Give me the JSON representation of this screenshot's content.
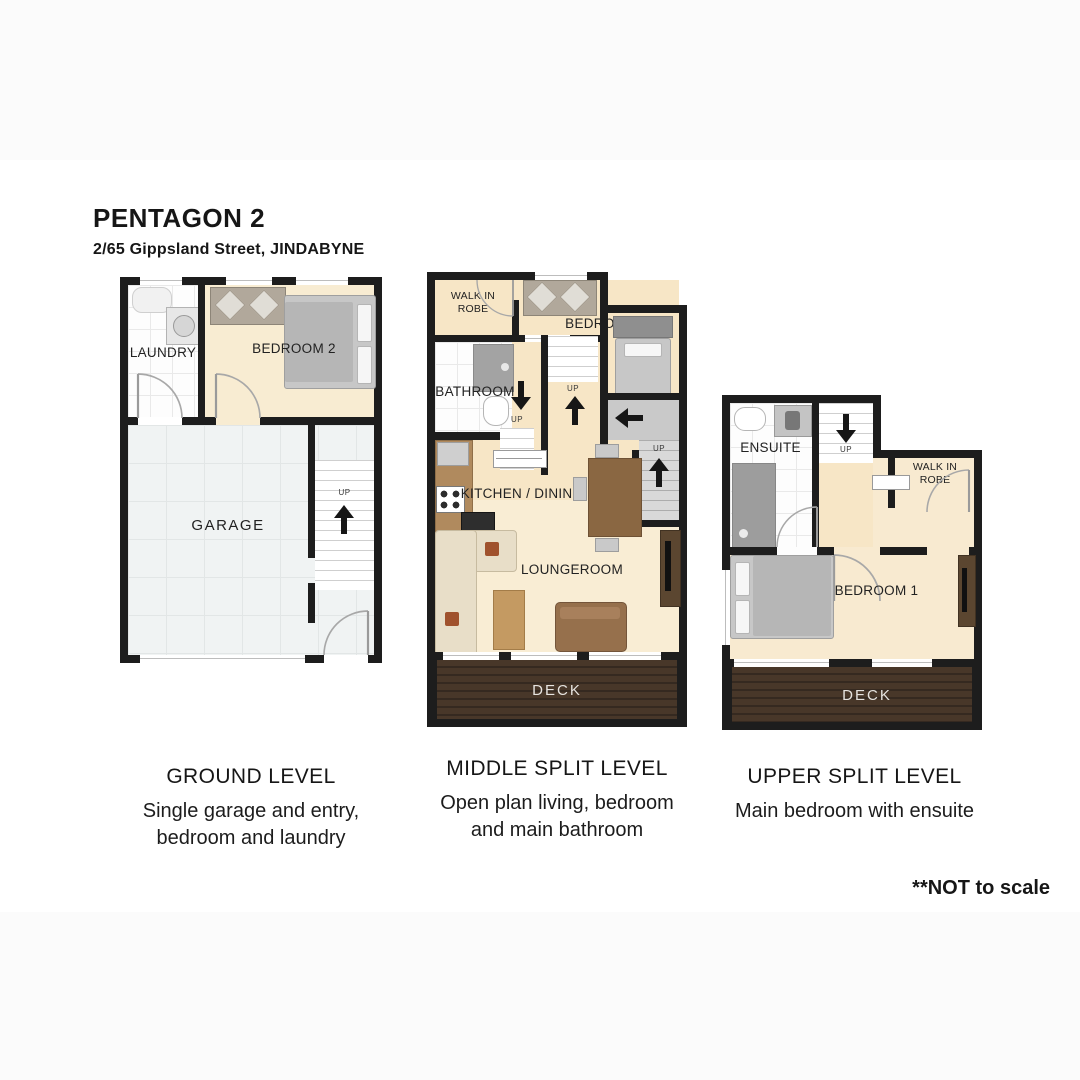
{
  "header": {
    "title": "PENTAGON 2",
    "subtitle": "2/65 Gippsland Street, JINDABYNE"
  },
  "footnote": "**NOT to scale",
  "labels": {
    "up": "UP"
  },
  "colors": {
    "wall": "#1d1d1d",
    "floor_cream": "#f7e6c6",
    "floor_tile": "#fdfdfd",
    "garage_floor": "#f0f3f3",
    "deck_wood": "#483729"
  },
  "plans": [
    {
      "caption": "GROUND LEVEL",
      "description": [
        "Single garage and entry,",
        "bedroom and laundry"
      ],
      "rooms": {
        "laundry": "LAUNDRY",
        "bedroom": "BEDROOM 2",
        "garage": "GARAGE"
      }
    },
    {
      "caption": "MIDDLE SPLIT LEVEL",
      "description": [
        "Open plan living, bedroom",
        "and main bathroom"
      ],
      "rooms": {
        "walk_in_robe": "WALK IN ROBE",
        "bedroom": "BEDROOM 3",
        "bathroom": "BATHROOM",
        "kitchen": "KITCHEN / DINING",
        "lounge": "LOUNGEROOM",
        "deck": "DECK"
      }
    },
    {
      "caption": "UPPER SPLIT LEVEL",
      "description": [
        "Main bedroom with ensuite"
      ],
      "rooms": {
        "ensuite": "ENSUITE",
        "walk_in_robe": "WALK IN ROBE",
        "bedroom": "BEDROOM 1",
        "deck": "DECK"
      }
    }
  ]
}
